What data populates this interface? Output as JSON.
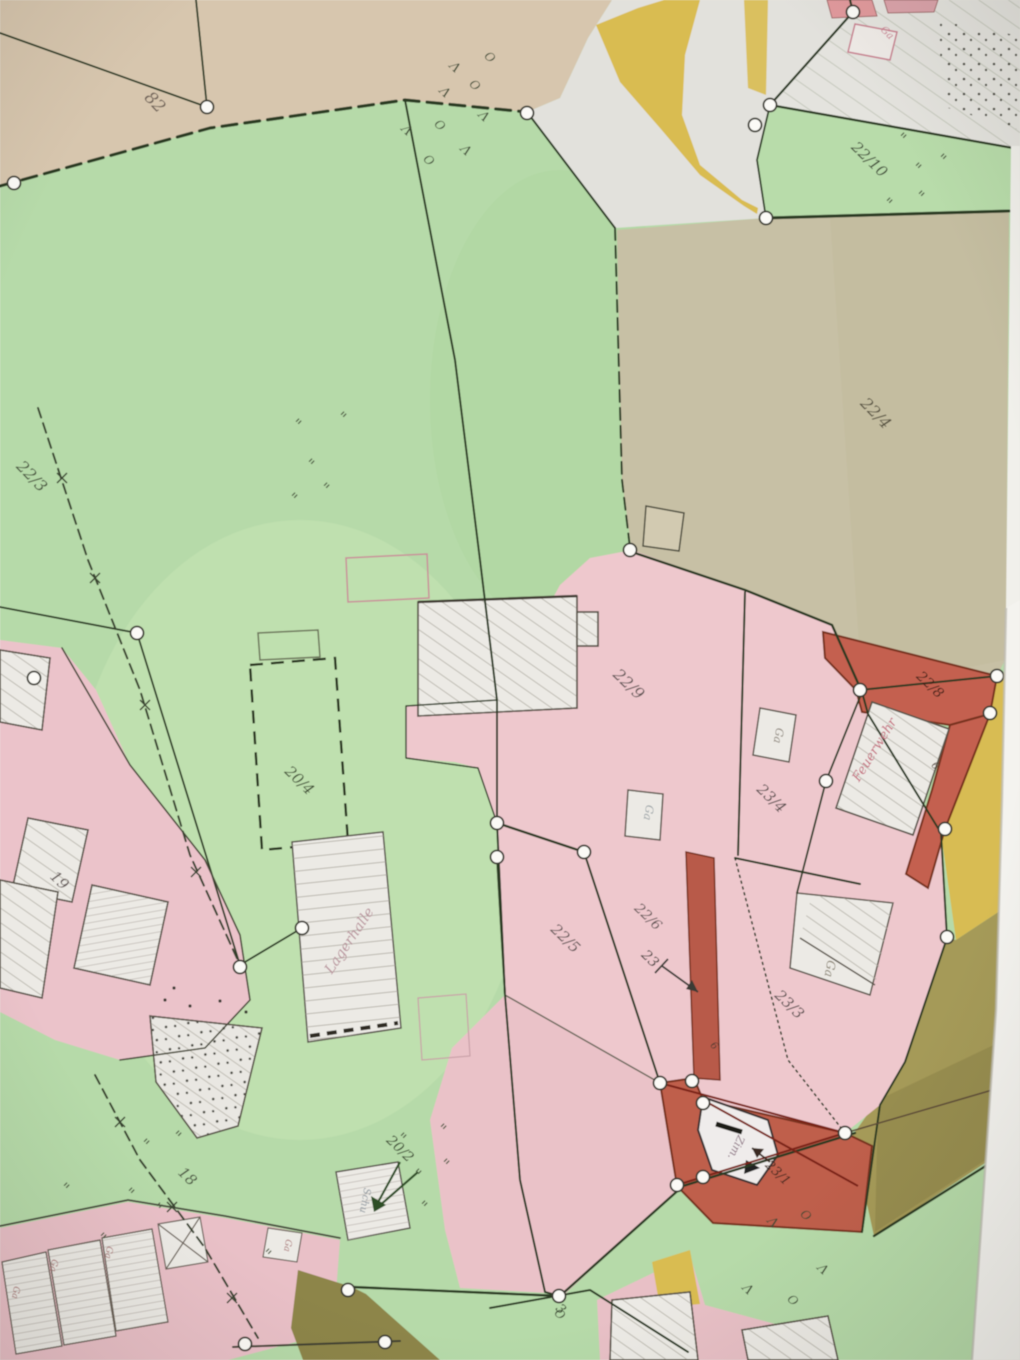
{
  "map": {
    "colors": {
      "paper": "#eae8e1",
      "meadow_green": "#b6daa9",
      "tan_top": "#d7c6ae",
      "tan_parcel": "#c7c0a5",
      "pink_builtup": "#eec8cd",
      "red_zone": "#c4614f",
      "road_yellow": "#d9bc51",
      "road_olive": "#a59a58",
      "road_dark": "#8d8549",
      "boundary_line": "#2c3a24",
      "red_line": "#7a2215",
      "building_white": "#eceae5"
    },
    "symbol_chars": {
      "grass": "\"",
      "conifer": "Λ",
      "broadleaf": "O"
    },
    "labels": [
      {
        "name": "parcel-82",
        "text": "82",
        "x": 151,
        "y": 106,
        "rot": 46,
        "size": 17,
        "color": "#6e6157"
      },
      {
        "name": "parcel-22-3",
        "text": "22/3",
        "x": 28,
        "y": 480,
        "rot": 46,
        "size": 16,
        "color": "#46523c"
      },
      {
        "name": "parcel-22-10",
        "text": "22/10",
        "x": 866,
        "y": 163,
        "rot": 44,
        "size": 15,
        "color": "#3e4836"
      },
      {
        "name": "parcel-22-4",
        "text": "22/4",
        "x": 872,
        "y": 417,
        "rot": 46,
        "size": 16,
        "color": "#56513f"
      },
      {
        "name": "parcel-22-9",
        "text": "22/9",
        "x": 625,
        "y": 688,
        "rot": 44,
        "size": 16,
        "color": "#5e5352"
      },
      {
        "name": "parcel-22-8",
        "text": "22/8",
        "x": 927,
        "y": 688,
        "rot": 44,
        "size": 14,
        "color": "#402018"
      },
      {
        "name": "parcel-23-4",
        "text": "23/4",
        "x": 768,
        "y": 802,
        "rot": 44,
        "size": 15,
        "color": "#564c4b"
      },
      {
        "name": "parcel-22-5",
        "text": "22/5",
        "x": 562,
        "y": 942,
        "rot": 44,
        "size": 15,
        "color": "#5e5352"
      },
      {
        "name": "parcel-22-6",
        "text": "22/6",
        "x": 645,
        "y": 920,
        "rot": 44,
        "size": 14,
        "color": "#5e5352"
      },
      {
        "name": "parcel-23",
        "text": "23",
        "x": 647,
        "y": 962,
        "rot": 44,
        "size": 14,
        "color": "#45403d"
      },
      {
        "name": "parcel-23-3",
        "text": "23/3",
        "x": 786,
        "y": 1008,
        "rot": 44,
        "size": 15,
        "color": "#564c4b"
      },
      {
        "name": "parcel-23-1",
        "text": "23/1",
        "x": 775,
        "y": 1176,
        "rot": 44,
        "size": 13,
        "color": "#40291f"
      },
      {
        "name": "parcel-19",
        "text": "19",
        "x": 56,
        "y": 884,
        "rot": 44,
        "size": 15,
        "color": "#5e5352"
      },
      {
        "name": "parcel-18",
        "text": "18",
        "x": 184,
        "y": 1180,
        "rot": 44,
        "size": 15,
        "color": "#4a5340"
      },
      {
        "name": "parcel-20-4",
        "text": "20/4",
        "x": 296,
        "y": 784,
        "rot": 44,
        "size": 15,
        "color": "#3d4b31"
      },
      {
        "name": "parcel-20-2",
        "text": "20/2",
        "x": 397,
        "y": 1152,
        "rot": 44,
        "size": 14,
        "color": "#35422a"
      },
      {
        "name": "parcel-3",
        "text": "3",
        "x": 558,
        "y": 1312,
        "rot": 44,
        "size": 13,
        "color": "#35422a"
      },
      {
        "name": "building-feuerwehr",
        "text": "Feuerwehr",
        "x": 878,
        "y": 752,
        "rot": -58,
        "size": 13,
        "color": "#c4697a"
      },
      {
        "name": "building-lagerhalle",
        "text": "Lagerhalle",
        "x": 353,
        "y": 943,
        "rot": -56,
        "size": 14,
        "color": "#b8929b"
      },
      {
        "name": "building-ga-top",
        "text": "Ga",
        "x": 885,
        "y": 35,
        "rot": 44,
        "size": 10,
        "color": "#cb8092"
      },
      {
        "name": "building-ga-1",
        "text": "Ga",
        "x": 775,
        "y": 735,
        "rot": 100,
        "size": 11,
        "color": "#8a8277"
      },
      {
        "name": "building-ga-2",
        "text": "Ga",
        "x": 645,
        "y": 812,
        "rot": 100,
        "size": 11,
        "color": "#9aa2a6"
      },
      {
        "name": "building-ga-3",
        "text": "Ga",
        "x": 826,
        "y": 968,
        "rot": 100,
        "size": 12,
        "color": "#87806f"
      },
      {
        "name": "building-ga-4",
        "text": "Ga",
        "x": 13,
        "y": 1292,
        "rot": 100,
        "size": 9,
        "color": "#a87070"
      },
      {
        "name": "building-ga-5",
        "text": "Ga",
        "x": 51,
        "y": 1265,
        "rot": 100,
        "size": 9,
        "color": "#a87070"
      },
      {
        "name": "building-ga-6",
        "text": "Ga",
        "x": 106,
        "y": 1252,
        "rot": 100,
        "size": 9,
        "color": "#a87070"
      },
      {
        "name": "building-ga-7",
        "text": "Ga",
        "x": 285,
        "y": 1245,
        "rot": 100,
        "size": 9,
        "color": "#a87070"
      },
      {
        "name": "building-schu",
        "text": "Schu",
        "x": 362,
        "y": 1200,
        "rot": 100,
        "size": 10,
        "color": "#8f98a0"
      },
      {
        "name": "building-zim",
        "text": "Zim.",
        "x": 733,
        "y": 1146,
        "rot": 115,
        "size": 11,
        "color": "#8a7080"
      },
      {
        "name": "house-number-6a",
        "text": "6",
        "x": 933,
        "y": 768,
        "rot": 44,
        "size": 10,
        "color": "#4c3c32"
      },
      {
        "name": "house-number-6b",
        "text": "6",
        "x": 712,
        "y": 1048,
        "rot": 44,
        "size": 10,
        "color": "#4c3c32"
      }
    ],
    "symbols": [
      {
        "kind": "grass",
        "x": 292,
        "y": 428
      },
      {
        "kind": "grass",
        "x": 337,
        "y": 421
      },
      {
        "kind": "grass",
        "x": 305,
        "y": 468
      },
      {
        "kind": "grass",
        "x": 320,
        "y": 492
      },
      {
        "kind": "grass",
        "x": 288,
        "y": 502
      },
      {
        "kind": "grass",
        "x": 897,
        "y": 142
      },
      {
        "kind": "grass",
        "x": 937,
        "y": 163
      },
      {
        "kind": "grass",
        "x": 912,
        "y": 172
      },
      {
        "kind": "grass",
        "x": 883,
        "y": 207
      },
      {
        "kind": "grass",
        "x": 915,
        "y": 200
      },
      {
        "kind": "grass",
        "x": 140,
        "y": 1148
      },
      {
        "kind": "grass",
        "x": 172,
        "y": 1140
      },
      {
        "kind": "grass",
        "x": 125,
        "y": 1197
      },
      {
        "kind": "grass",
        "x": 153,
        "y": 1212
      },
      {
        "kind": "grass",
        "x": 60,
        "y": 1192
      },
      {
        "kind": "grass",
        "x": 97,
        "y": 1242
      },
      {
        "kind": "grass",
        "x": 397,
        "y": 1142
      },
      {
        "kind": "grass",
        "x": 437,
        "y": 1133
      },
      {
        "kind": "grass",
        "x": 412,
        "y": 1178
      },
      {
        "kind": "grass",
        "x": 440,
        "y": 1168
      },
      {
        "kind": "grass",
        "x": 418,
        "y": 1210
      },
      {
        "kind": "grass",
        "x": 262,
        "y": 1258
      },
      {
        "kind": "conifer",
        "x": 442,
        "y": 95
      },
      {
        "kind": "conifer",
        "x": 481,
        "y": 119
      },
      {
        "kind": "conifer",
        "x": 404,
        "y": 133
      },
      {
        "kind": "conifer",
        "x": 463,
        "y": 153
      },
      {
        "kind": "conifer",
        "x": 452,
        "y": 70
      },
      {
        "kind": "conifer",
        "x": 770,
        "y": 1225
      },
      {
        "kind": "conifer",
        "x": 745,
        "y": 1292
      },
      {
        "kind": "conifer",
        "x": 820,
        "y": 1272
      },
      {
        "kind": "broadleaf",
        "x": 472,
        "y": 88
      },
      {
        "kind": "broadleaf",
        "x": 437,
        "y": 128
      },
      {
        "kind": "broadleaf",
        "x": 426,
        "y": 163
      },
      {
        "kind": "broadleaf",
        "x": 487,
        "y": 60
      },
      {
        "kind": "broadleaf",
        "x": 803,
        "y": 1218
      },
      {
        "kind": "broadleaf",
        "x": 790,
        "y": 1303
      },
      {
        "kind": "broadleaf",
        "x": 557,
        "y": 1317
      }
    ]
  }
}
